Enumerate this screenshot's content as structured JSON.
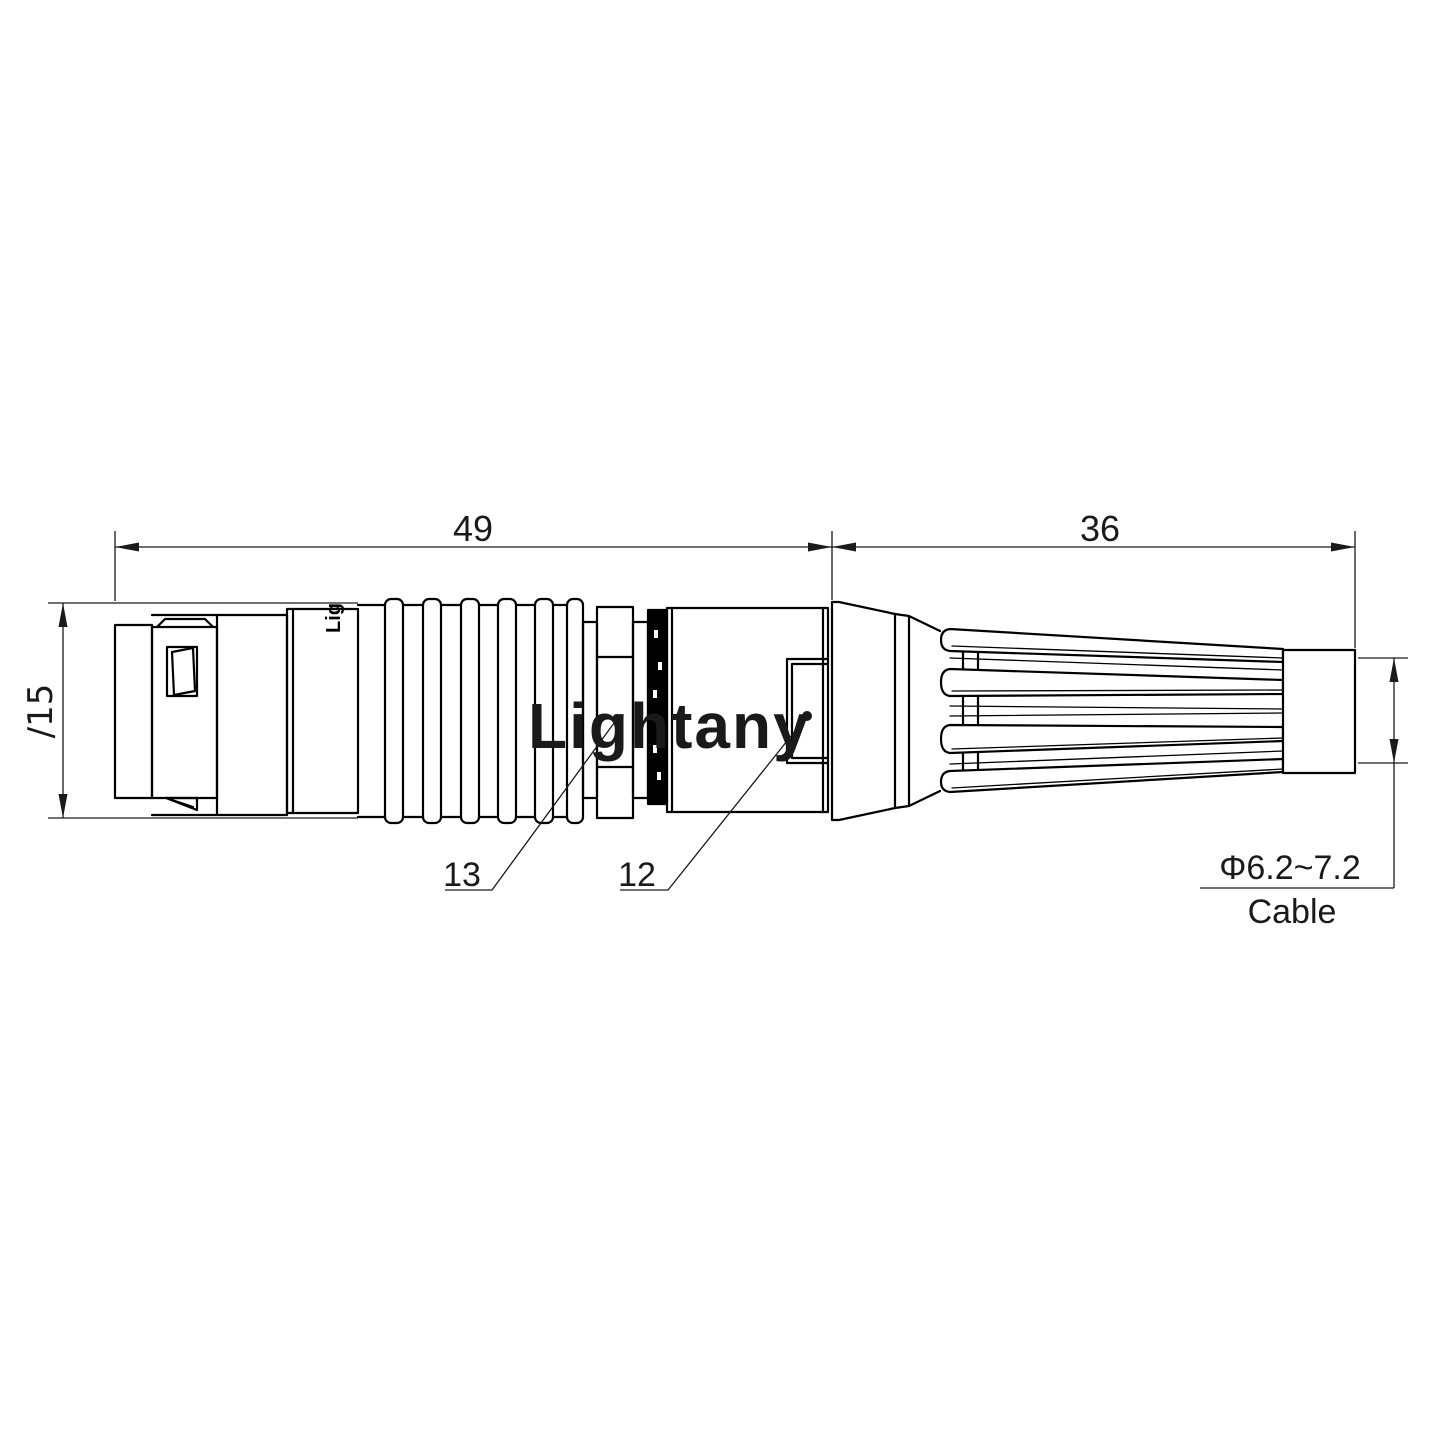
{
  "dimensions": {
    "front_length": "49",
    "boot_length": "36",
    "shell_diameter": "∕15",
    "cable_diameter": "Φ6.2~7.2",
    "cable_label": "Cable"
  },
  "callouts": {
    "nut_part_number": "13",
    "housing_part_number": "12"
  },
  "markings": {
    "shell_print": "Lig"
  },
  "watermark": {
    "text": "Lightany"
  },
  "colors": {
    "line": "#000000",
    "dim": "#1a1a1a",
    "watermark": "rgba(219,82,82,0.33)",
    "background": "#ffffff"
  }
}
